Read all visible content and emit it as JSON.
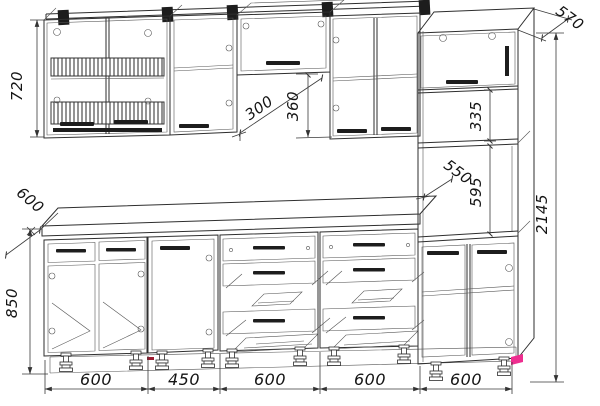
{
  "drawing": {
    "type": "kitchen-assembly-dimension-drawing",
    "background": "#ffffff",
    "line_color": "#2e2e2e",
    "accent_color": "#ee2d8f",
    "vertical_dims": {
      "wall_cabinet_height": "720",
      "base_unit_height": "850",
      "hood_unit_drop": "360",
      "tall_upper_shelf_section": "335",
      "tall_niche_height": "595",
      "total_height": "2145"
    },
    "depth_dims": {
      "worktop_depth": "600",
      "wall_cabinet_depth": "300",
      "tall_inner_depth": "550",
      "tall_unit_depth": "570"
    },
    "width_dims": [
      "600",
      "450",
      "600",
      "600",
      "600"
    ]
  }
}
